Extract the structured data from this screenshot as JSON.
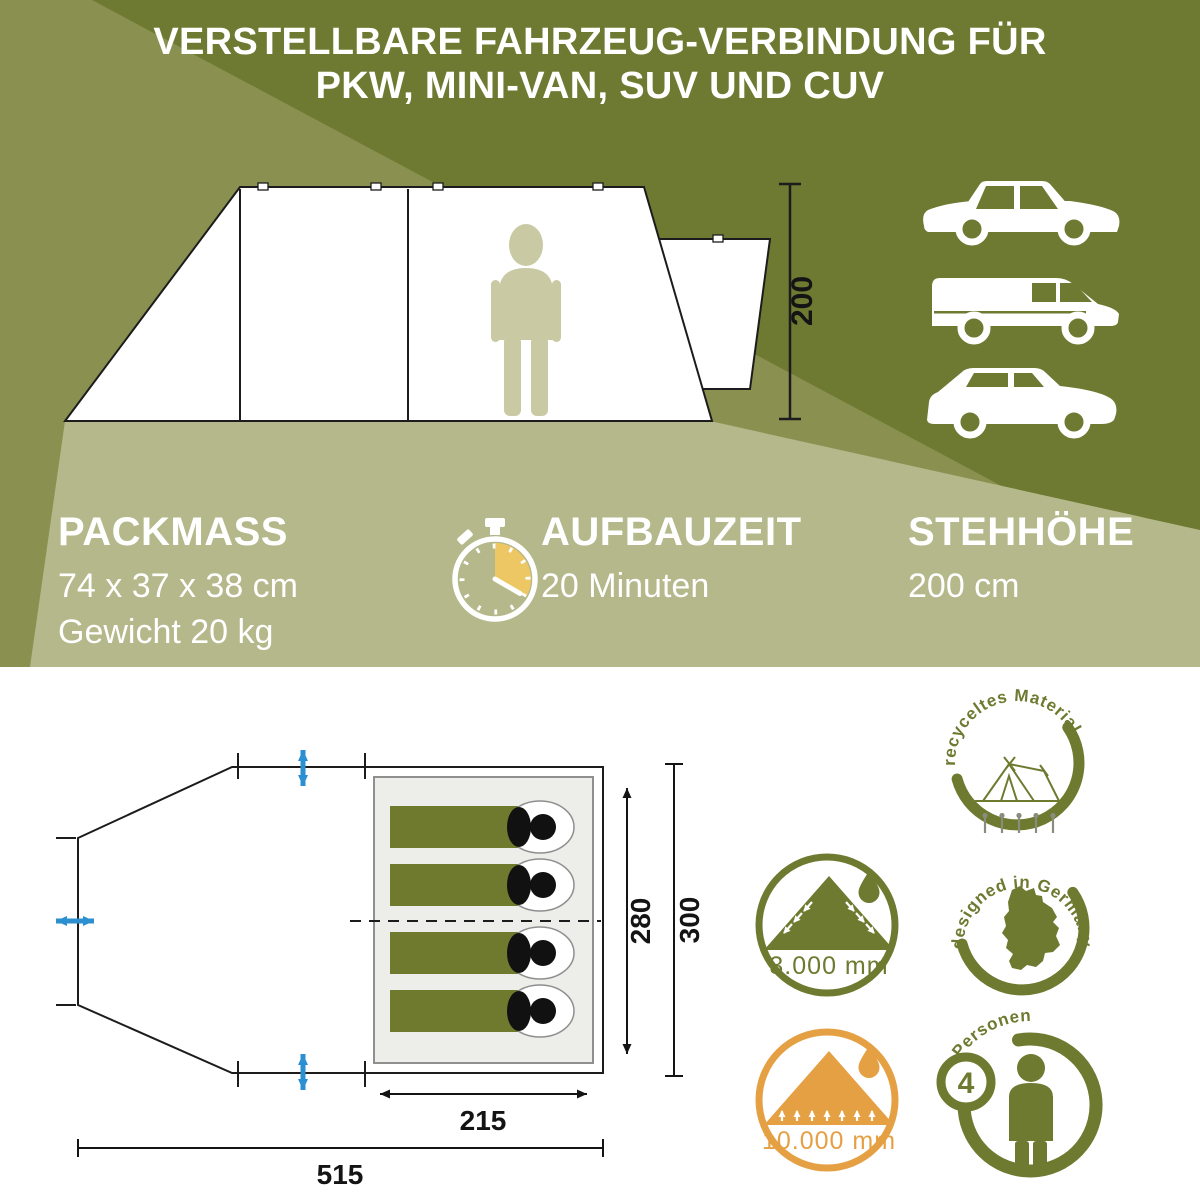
{
  "colors": {
    "dark_olive": "#6E7A31",
    "mid_olive": "#8A9150",
    "sage": "#B4B88A",
    "badge_olive": "#6D7A2F",
    "orange": "#E5A044",
    "stopwatch_gold": "#EDC763",
    "arrow_blue": "#2B8FD0",
    "figure_beige": "#C9C9A4",
    "sleeping_bag_olive": "#6F7A2E"
  },
  "headline": {
    "line1": "VERSTELLBARE FAHRZEUG-VERBINDUNG FÜR",
    "line2": "PKW, MINI-VAN, SUV UND CUV"
  },
  "side_view": {
    "height_dim": "200",
    "vehicles": [
      "sedan-car",
      "mini-van",
      "suv"
    ]
  },
  "specs": {
    "packmass": {
      "heading": "PACKMASS",
      "line1": "74 x 37 x 38 cm",
      "line2": "Gewicht 20 kg"
    },
    "aufbauzeit": {
      "heading": "AUFBAUZEIT",
      "line1": "20 Minuten",
      "icon": "stopwatch-icon"
    },
    "stehhoehe": {
      "heading": "STEHHÖHE",
      "line1": "200 cm"
    }
  },
  "floor_plan": {
    "cabin_width": "280",
    "outer_width": "300",
    "cabin_length": "215",
    "total_length": "515",
    "sleeping_bag_count": 4
  },
  "badges": {
    "recycled": {
      "label": "recyceltes Material"
    },
    "water_3000": {
      "label": "3.000 mm"
    },
    "germany": {
      "label": "designed in Germany"
    },
    "water_10000": {
      "label": "10.000 mm"
    },
    "persons": {
      "label": "Personen",
      "value": "4"
    }
  }
}
